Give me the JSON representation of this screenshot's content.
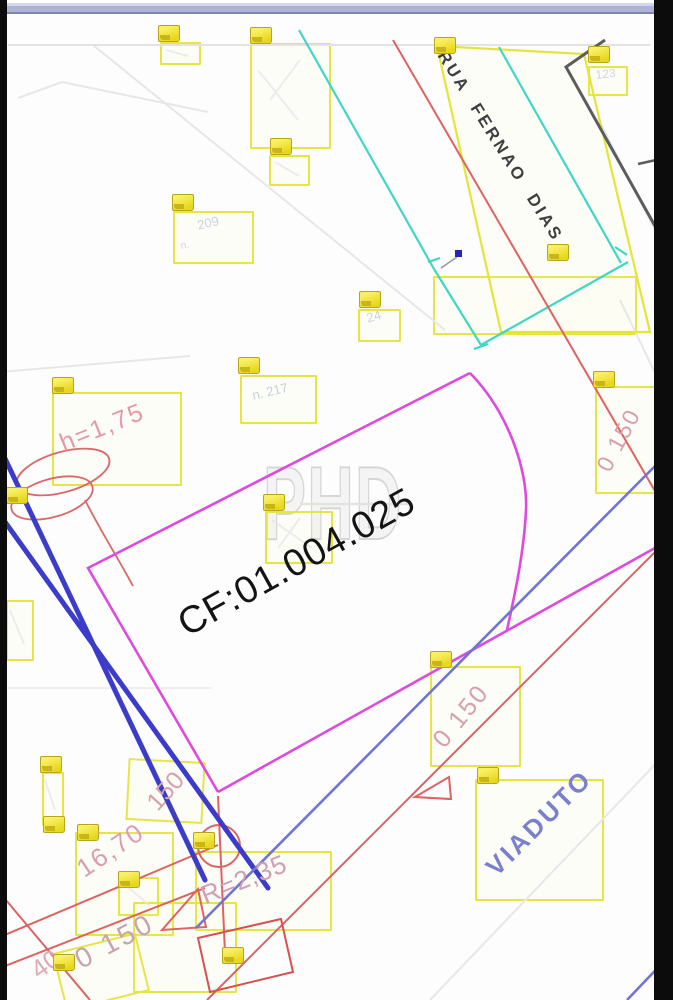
{
  "drawing": {
    "street_label": "RUA FERNAO DIAS",
    "lot_code": "CF:01.004.025",
    "viaduct_label": "VIADUTO",
    "watermark": "PHD",
    "dimensions": {
      "h": "h=1,75",
      "len_16_70": "16,70",
      "d_150": "150",
      "d_0_150_a": "0 150",
      "radius": "R=2,35",
      "d_0_150_b": "0 150",
      "d_0_150_c": "0 150",
      "corner_40": "40"
    },
    "house_numbers": {
      "n_123": "123",
      "n_209_prefix": "n.",
      "n_209": "209",
      "n_24": "24",
      "n_217": "n. 217"
    },
    "colors": {
      "lot_magenta": "#de4ade",
      "markup_yellow": "#e4e43a",
      "street_red": "#dd6262",
      "guide_blue": "#3c3cca",
      "dim_pink": "#d8a0ad",
      "viaduct_blue": "#7b80cd",
      "survey_cyan": "#3fd6c6"
    }
  }
}
